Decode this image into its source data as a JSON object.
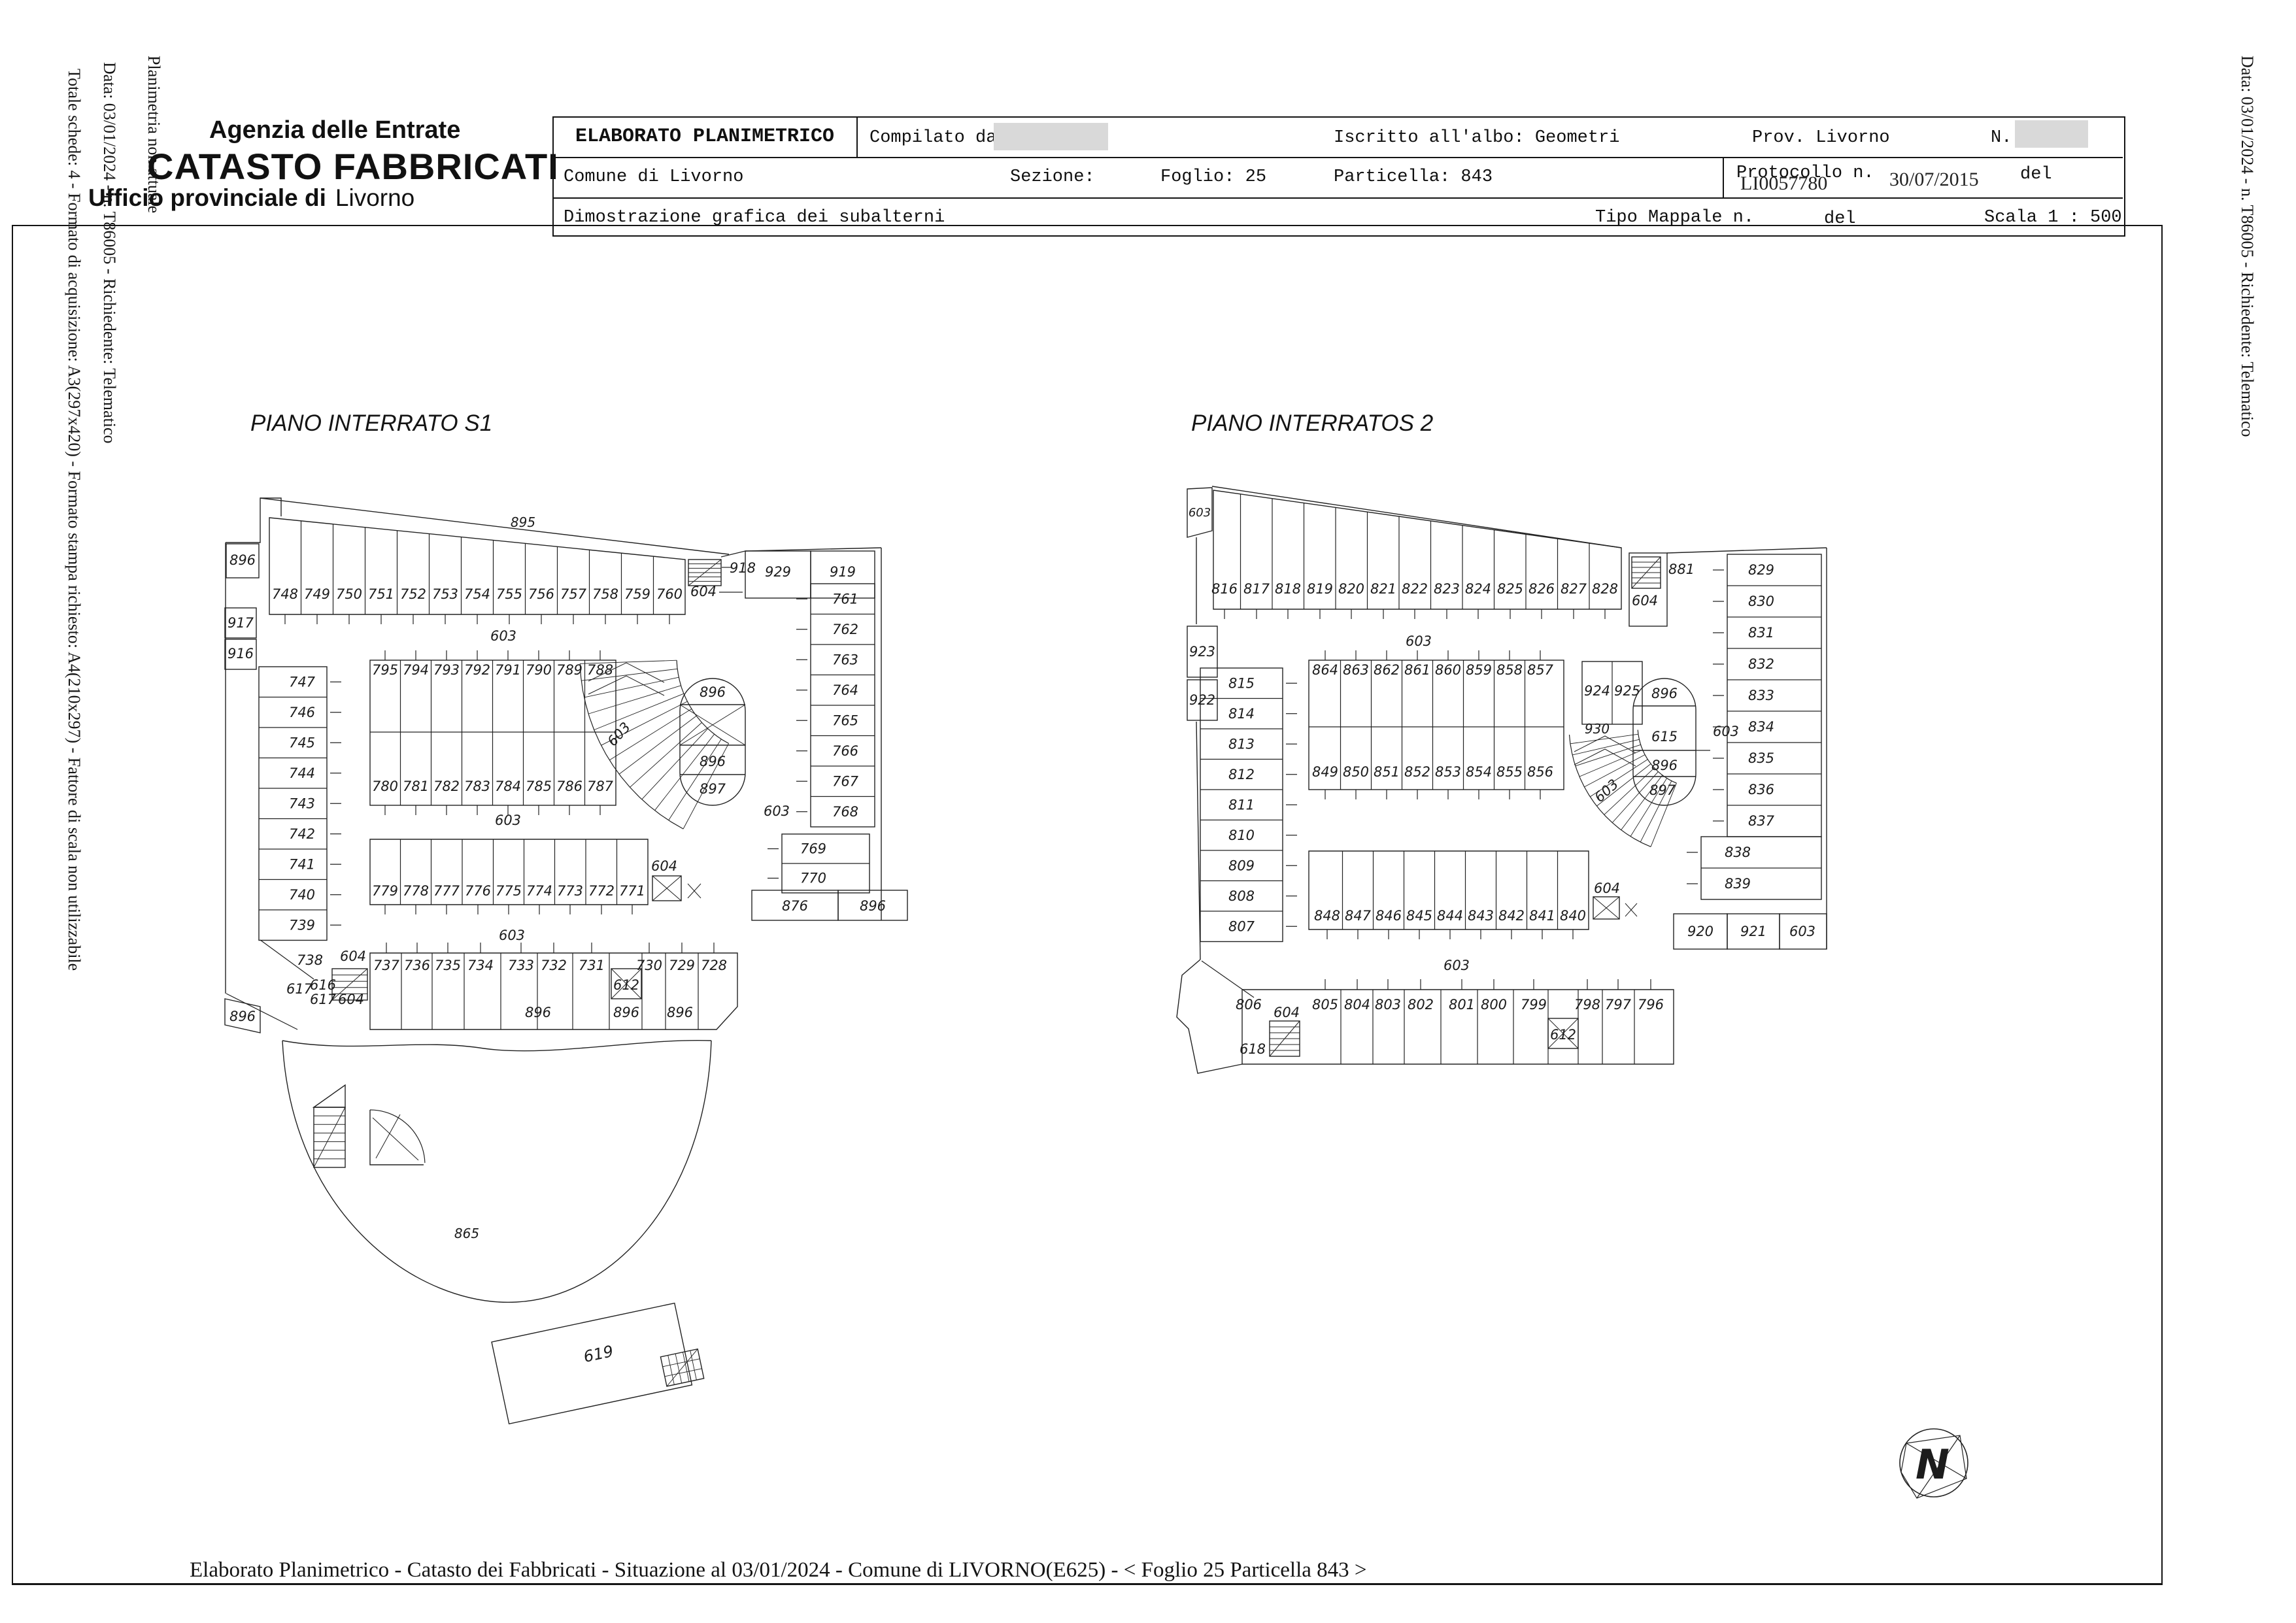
{
  "header": {
    "agency": "Agenzia delle Entrate",
    "registry": "CATASTO FABBRICATI",
    "office_prefix": "Ufficio provinciale di",
    "office_city": "Livorno"
  },
  "margins": {
    "left_note": "Planimetria non attuale",
    "left_meta": "Data: 03/01/2024 - n. T86005 - Richiedente: Telematico",
    "left_format": "Totale schede: 4 - Formato di acquisizione: A3(297x420)  - Formato stampa richiesto: A4(210x297) - Fattore di scala non utilizzabile",
    "right_meta": "Data: 03/01/2024 - n. T86005 - Richiedente: Telematico"
  },
  "table": {
    "title": "ELABORATO PLANIMETRICO",
    "compilato_label": "Compilato da:",
    "iscritto": "Iscritto all'albo: Geometri",
    "prov": "Prov. Livorno",
    "n_label": "N.",
    "comune": "Comune di Livorno",
    "sezione": "Sezione:",
    "foglio": "Foglio: 25",
    "particella": "Particella: 843",
    "protocollo_label": "Protocollo n.",
    "protocollo_value": "LI0057780",
    "protocollo_date": "30/07/2015",
    "del1": "del",
    "dimostrazione": "Dimostrazione grafica dei subalterni",
    "tipo_mappale": "Tipo Mappale n.",
    "del2": "del",
    "scala": "Scala 1 : 500"
  },
  "footer": {
    "line": "Elaborato Planimetrico - Catasto dei Fabbricati - Situazione al 03/01/2024 - Comune di LIVORNO(E625) - < Foglio 25 Particella 843 >"
  },
  "plan_s1": {
    "title": "PIANO INTERRATO S1",
    "roof": "895",
    "top_row": [
      "748",
      "749",
      "750",
      "751",
      "752",
      "753",
      "754",
      "755",
      "756",
      "757",
      "758",
      "759",
      "760"
    ],
    "left_small": [
      "896",
      "917",
      "916"
    ],
    "stair_label": "918",
    "elev_top": "604",
    "room_929": "929",
    "room_919": "919",
    "right_col": [
      "761",
      "762",
      "763",
      "764",
      "765",
      "766",
      "767",
      "768"
    ],
    "right_col2": [
      "769",
      "770"
    ],
    "room_876": "876",
    "room_896r": "896",
    "corridors": [
      "603",
      "603",
      "603",
      "603"
    ],
    "ramp_label": "603",
    "island1_top": [
      "795",
      "794",
      "793",
      "792",
      "791",
      "790",
      "789",
      "788"
    ],
    "island1_bottom": [
      "780",
      "781",
      "782",
      "783",
      "784",
      "785",
      "786",
      "787"
    ],
    "stadium": [
      "896",
      "896",
      "897"
    ],
    "island2": [
      "779",
      "778",
      "777",
      "776",
      "775",
      "774",
      "773",
      "772",
      "771"
    ],
    "elev_island2": "604",
    "left_col": [
      "747",
      "746",
      "745",
      "744",
      "743",
      "742",
      "741",
      "740",
      "739"
    ],
    "room_738": "738",
    "bottom_row": [
      "737",
      "736",
      "735",
      "734",
      "733",
      "732",
      "731",
      "730",
      "729",
      "728"
    ],
    "elev_612": "612",
    "bottom_896": [
      "896",
      "896",
      "896"
    ],
    "cluster": [
      "604",
      "616",
      "617",
      "617",
      "604"
    ],
    "room_896b": "896",
    "dome": "865",
    "building": "619"
  },
  "plan_s2": {
    "title": "PIANO INTERRATOS 2",
    "corner_603": "603",
    "top_row": [
      "816",
      "817",
      "818",
      "819",
      "820",
      "821",
      "822",
      "823",
      "824",
      "825",
      "826",
      "827",
      "828"
    ],
    "stair_label": "881",
    "elev_top": "604",
    "left_small": [
      "923",
      "922"
    ],
    "right_col": [
      "829",
      "830",
      "831",
      "832",
      "833",
      "834",
      "835",
      "836",
      "837"
    ],
    "right_col2": [
      "838",
      "839"
    ],
    "bottom_cells": [
      "920",
      "921",
      "603"
    ],
    "corridors": [
      "603",
      "603",
      "603"
    ],
    "ramp_label": "603",
    "island1_top": [
      "864",
      "863",
      "862",
      "861",
      "860",
      "859",
      "858",
      "857"
    ],
    "island1_bottom": [
      "849",
      "850",
      "851",
      "852",
      "853",
      "854",
      "855",
      "856"
    ],
    "rooms_924_925": [
      "924",
      "925"
    ],
    "room_930": "930",
    "stadium": [
      "896",
      "615",
      "896",
      "897"
    ],
    "island2": [
      "848",
      "847",
      "846",
      "845",
      "844",
      "843",
      "842",
      "841",
      "840"
    ],
    "elev_island2": "604",
    "left_col": [
      "815",
      "814",
      "813",
      "812",
      "811",
      "810",
      "809",
      "808",
      "807"
    ],
    "bottom_row": [
      "805",
      "804",
      "803",
      "802",
      "801",
      "800",
      "799",
      "798",
      "797",
      "796"
    ],
    "elev_612": "612",
    "room_806": "806",
    "cluster_604": "604",
    "room_618": "618"
  },
  "compass": {
    "letter": "N"
  }
}
